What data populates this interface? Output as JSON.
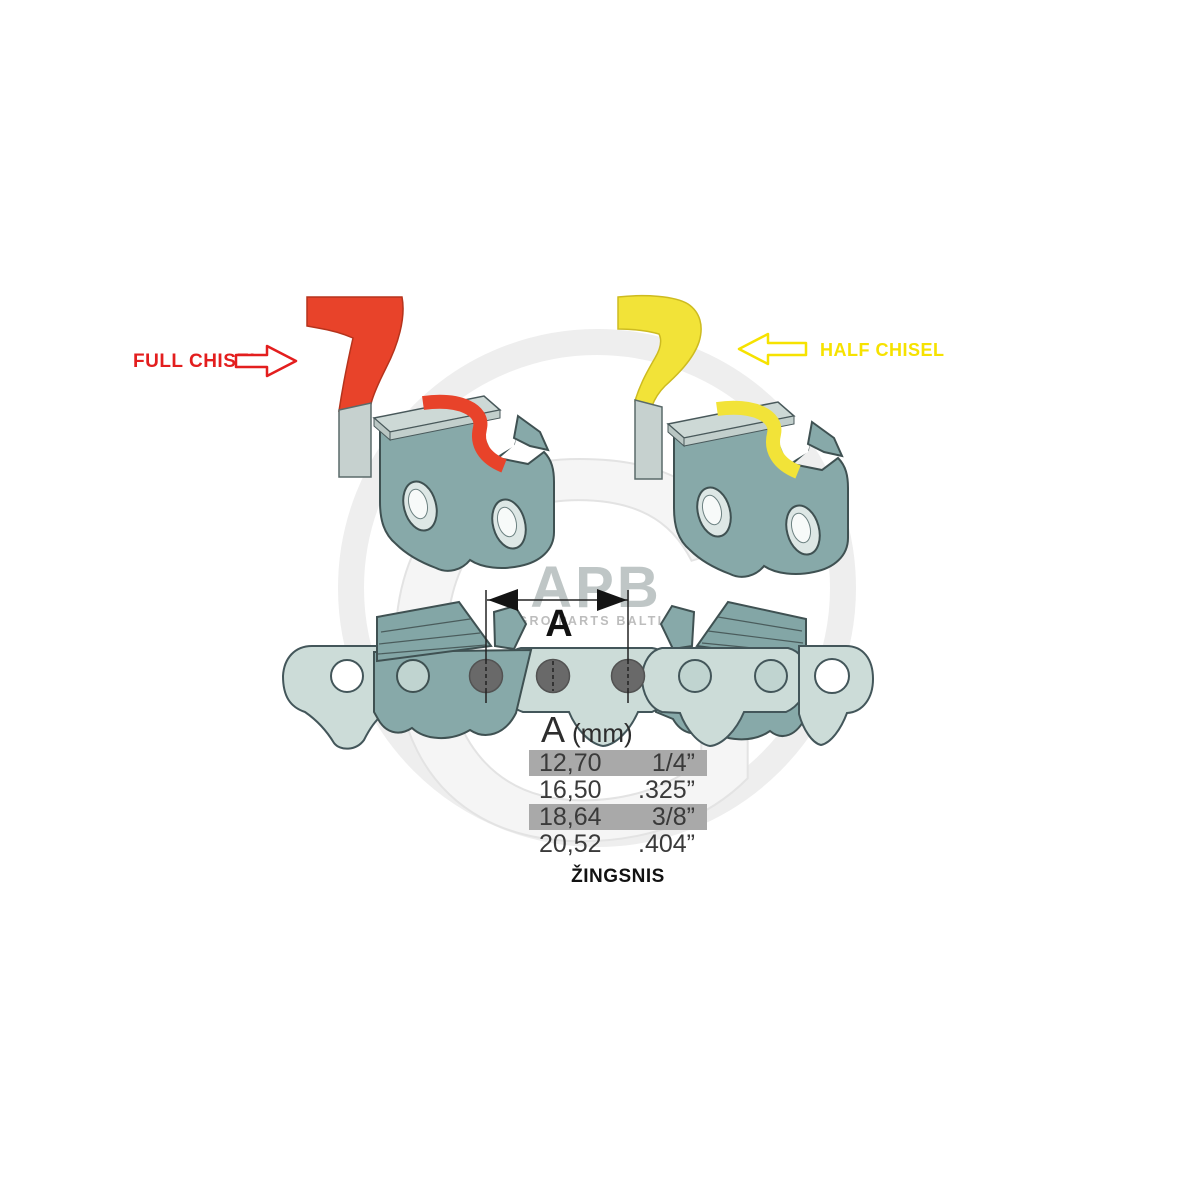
{
  "title": "Chainsaw chain pitch diagram",
  "watermark": {
    "logo": "APB",
    "subtitle": "AGRO PARTS BALTIJA",
    "glyph": "G"
  },
  "labels": {
    "full_chisel": "FULL CHISEL",
    "half_chisel": "HALF CHISEL"
  },
  "dimension": {
    "label": "A"
  },
  "table": {
    "header_symbol": "A",
    "header_unit": "(mm)",
    "rows": [
      {
        "mm": "12,70",
        "inch": "1/4”",
        "highlighted": true
      },
      {
        "mm": "16,50",
        "inch": ".325”",
        "highlighted": false
      },
      {
        "mm": "18,64",
        "inch": "3/8”",
        "highlighted": true
      },
      {
        "mm": "20,52",
        "inch": ".404”",
        "highlighted": false
      }
    ],
    "caption": "ŽINGSNIS"
  },
  "chart_data": {
    "type": "table",
    "title": "Chain pitch A (mm) to inches",
    "columns": [
      "A (mm)",
      "inches"
    ],
    "rows": [
      [
        "12,70",
        "1/4”"
      ],
      [
        "16,50",
        ".325”"
      ],
      [
        "18,64",
        "3/8”"
      ],
      [
        "20,52",
        ".404”"
      ]
    ]
  },
  "colors": {
    "full_chisel_red": "#e8432a",
    "half_chisel_yellow": "#f2e338",
    "label_red": "#e31e1e",
    "label_yellow": "#f6e200",
    "link_teal": "#87a9a9",
    "chain_light": "#ccdcd8",
    "rivet_gray": "#696969",
    "row_highlight": "#a9a9a9",
    "watermark_gray": "#ededed"
  }
}
